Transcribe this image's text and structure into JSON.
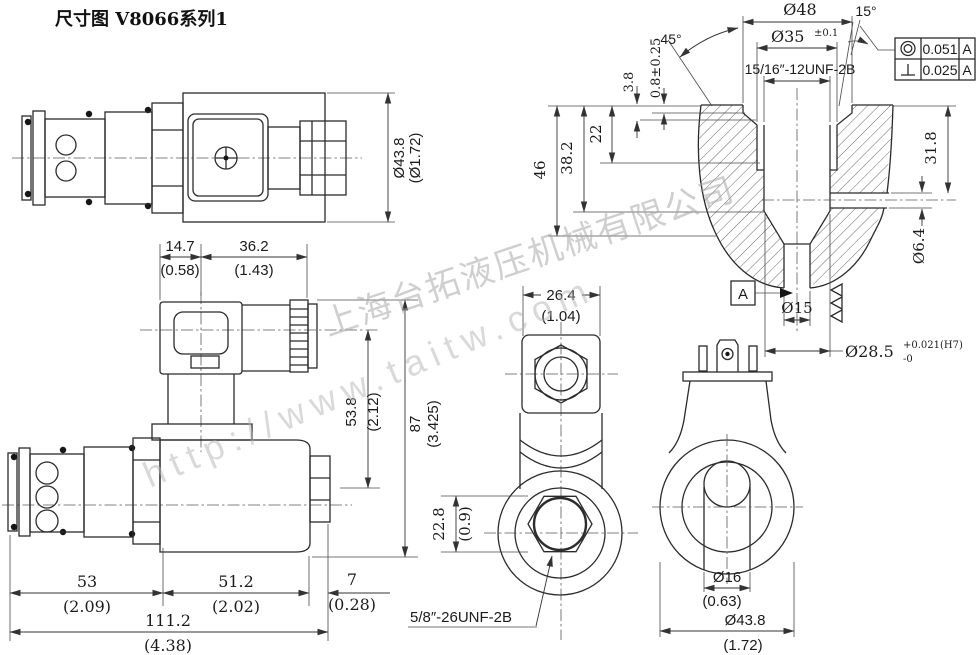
{
  "title": "尺寸图 V8066系列1",
  "watermark": {
    "company": "上海台拓液压机械有限公司",
    "url": "http://www.taitw.com"
  },
  "side_view": {
    "dia": "Ø43.8",
    "dia_inch": "(Ø1.72)"
  },
  "cavity_view": {
    "angle_chamfer": "45°",
    "angle_taper": "15°",
    "dia_spotface": "Ø48",
    "dia_thread_major": "Ø35",
    "dia_thread_major_tol": "±0.1",
    "thread_spec": "15/16″-12UNF-2B",
    "depth_spotface": "0.8±0.25",
    "depth_chamfer": "3.8",
    "depth_thread": "22",
    "depth_step": "38.2",
    "depth_total": "46",
    "depth_port": "31.8",
    "dia_port": "Ø6.4",
    "dia_pilot": "Ø15",
    "dia_bore": "Ø28.5",
    "dia_bore_tol_upper": "+0.021(H7)",
    "dia_bore_tol_lower": "-0",
    "datum_label": "A",
    "tolerance_frame": {
      "rows": [
        {
          "symbol": "concentricity",
          "value": "0.051",
          "datum": "A"
        },
        {
          "symbol": "perpendicularity",
          "value": "0.025",
          "datum": "A"
        }
      ]
    }
  },
  "front_view": {
    "w_connector": "14.7",
    "w_connector_inch": "(0.58)",
    "w_coil_top": "36.2",
    "w_coil_top_inch": "(1.43)",
    "h_center": "53.8",
    "h_center_inch": "(2.12)",
    "h_total": "87",
    "h_total_inch": "(3.425)",
    "l_cartridge": "53",
    "l_cartridge_inch": "(2.09)",
    "l_coil": "51.2",
    "l_coil_inch": "(2.02)",
    "l_nut": "7",
    "l_nut_inch": "(0.28)",
    "l_total": "111.2",
    "l_total_inch": "(4.38)"
  },
  "bottom_view": {
    "w_body": "26.4",
    "w_body_inch": "(1.04)",
    "hex_af": "22.8",
    "hex_af_inch": "(0.9)",
    "thread_spec": "5/8″-26UNF-2B"
  },
  "coil_end_view": {
    "dia_tube": "Ø16",
    "dia_tube_inch": "(0.63)",
    "dia_coil": "Ø43.8",
    "dia_coil_inch": "(1.72)"
  }
}
